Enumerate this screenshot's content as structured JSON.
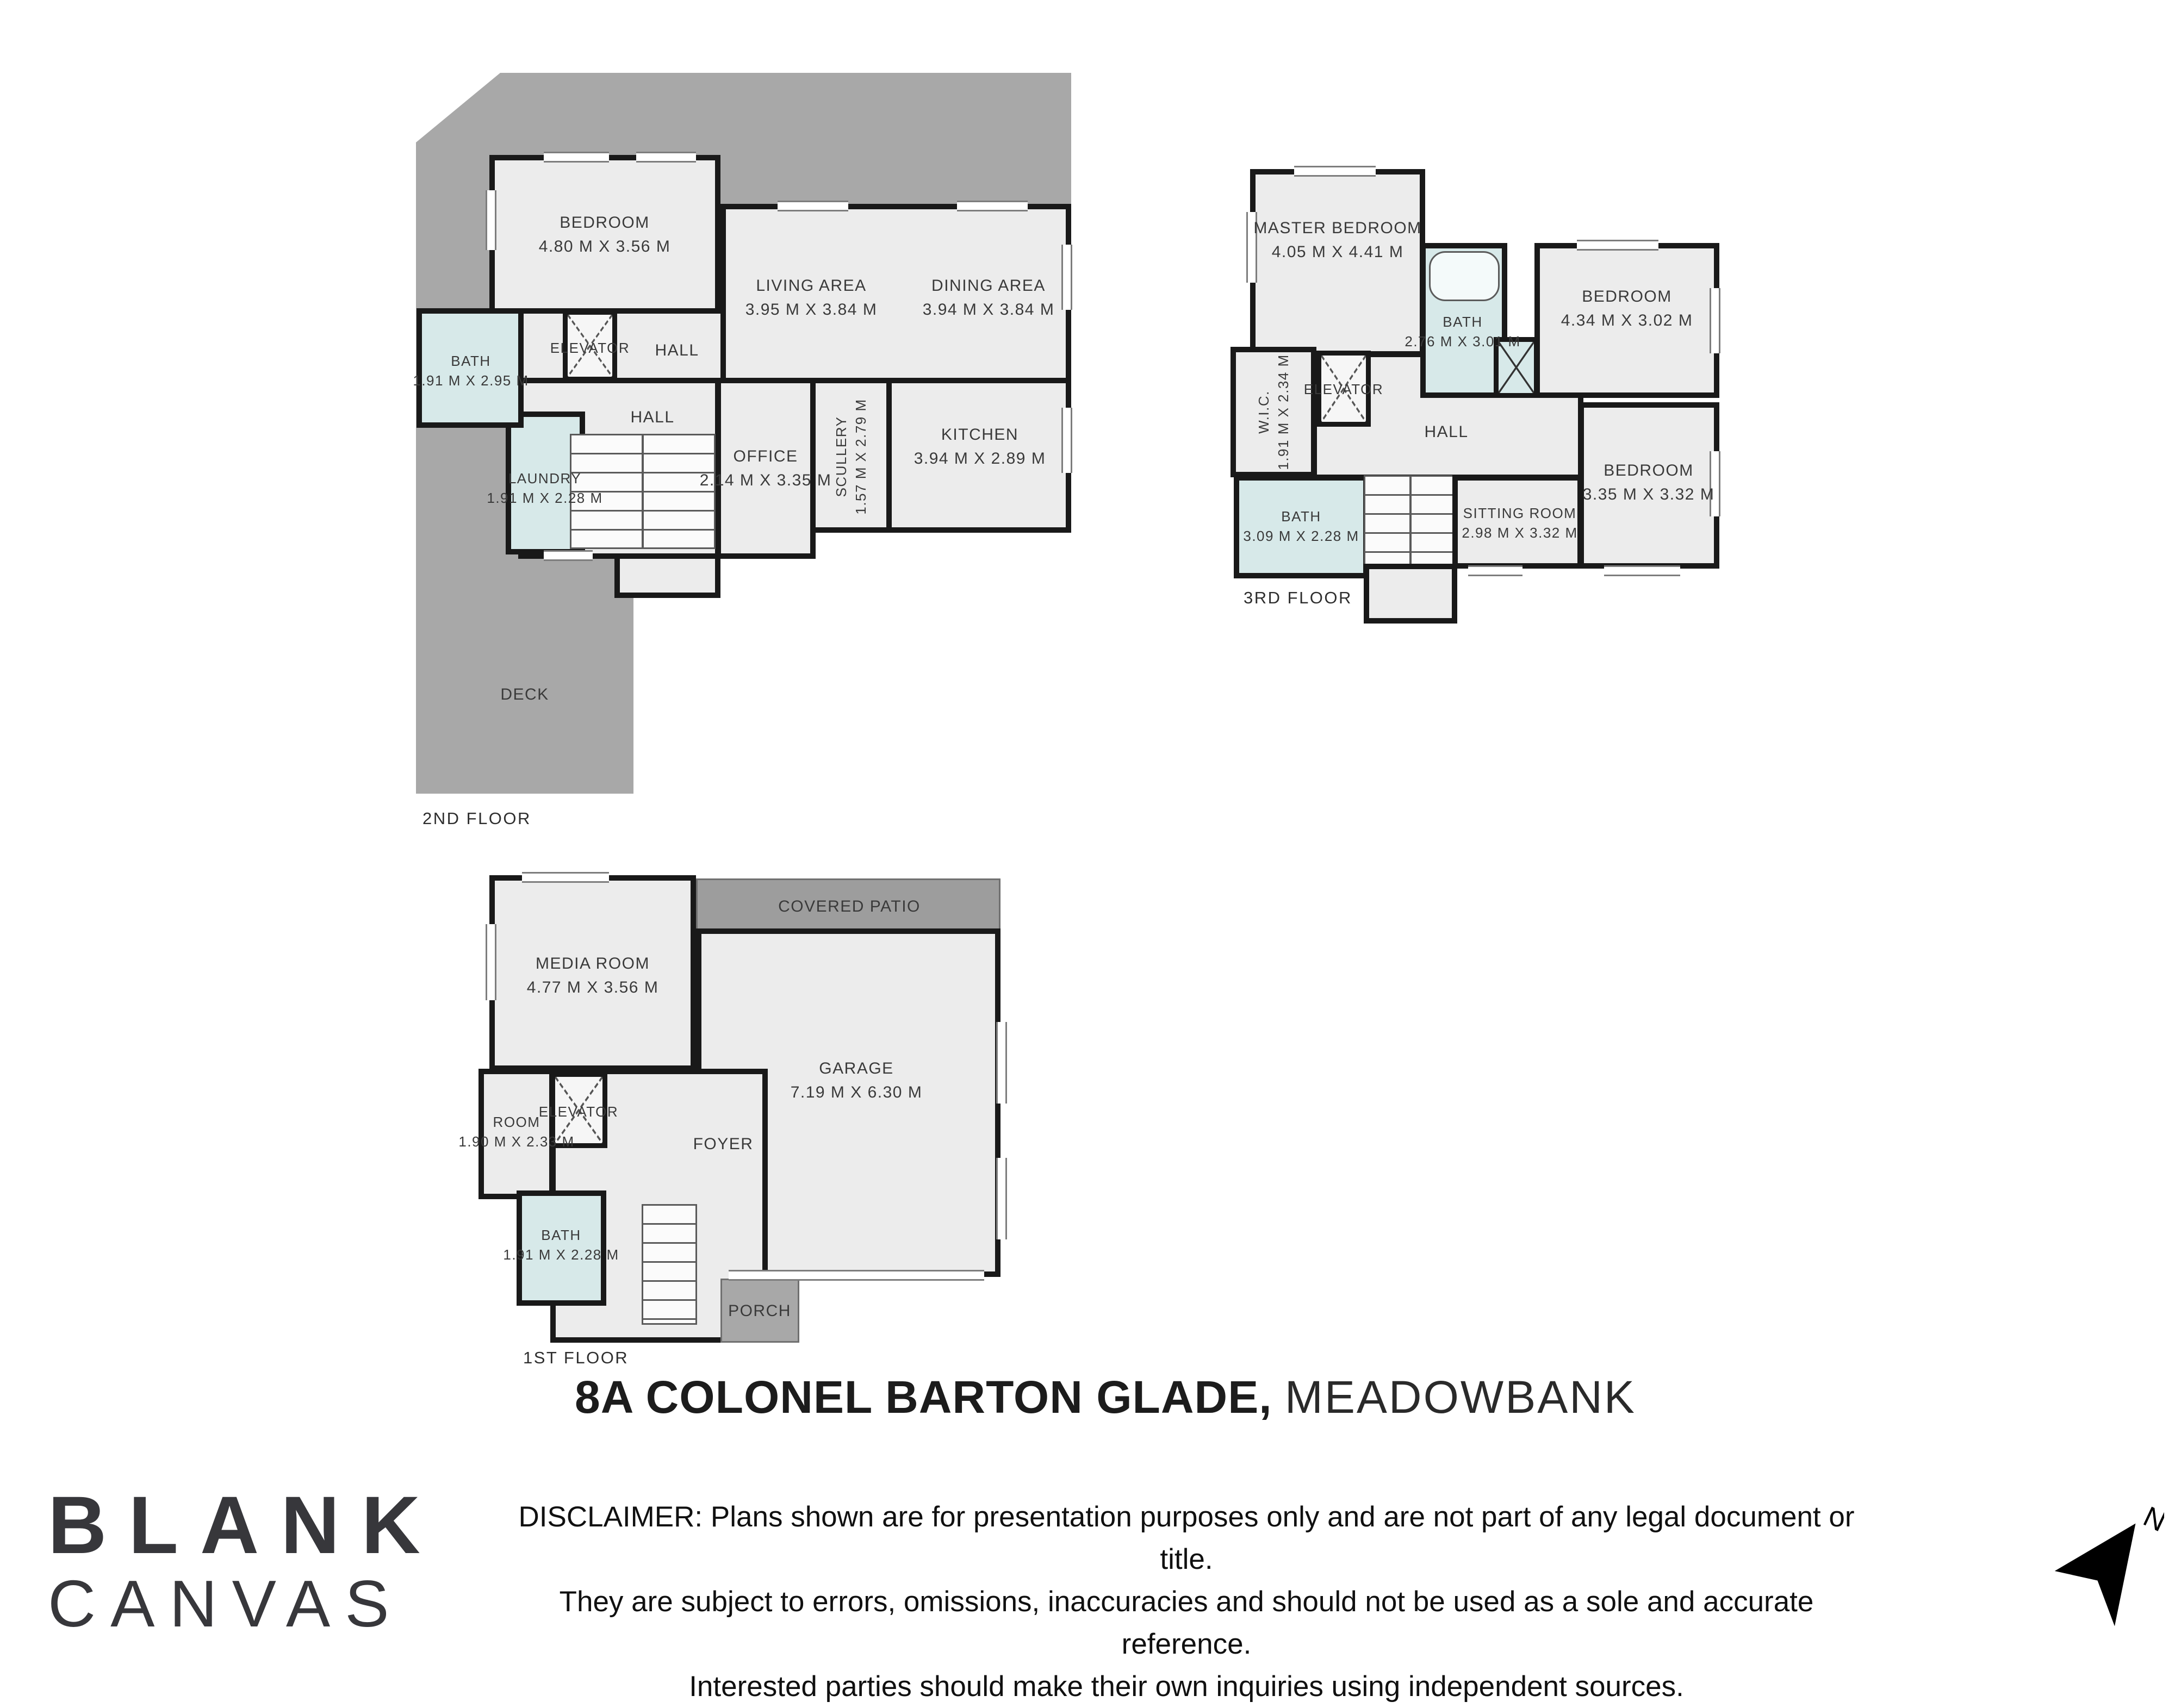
{
  "title": {
    "address": "8A COLONEL BARTON GLADE,",
    "suburb": "MEADOWBANK"
  },
  "floors": [
    {
      "label": "2ND FLOOR",
      "rooms": [
        {
          "name": "BEDROOM",
          "dims": "4.80 M X 3.56 M"
        },
        {
          "name": "LIVING AREA",
          "dims": "3.95 M X 3.84 M"
        },
        {
          "name": "DINING AREA",
          "dims": "3.94 M X 3.84 M"
        },
        {
          "name": "HALL"
        },
        {
          "name": "ELEVATOR"
        },
        {
          "name": "BATH",
          "dims": "1.91 M X 2.95 M"
        },
        {
          "name": "HALL"
        },
        {
          "name": "LAUNDRY",
          "dims": "1.91 M X 2.28 M"
        },
        {
          "name": "OFFICE",
          "dims": "2.14 M X 3.35 M"
        },
        {
          "name": "SCULLERY",
          "dims": "1.57 M X 2.79 M"
        },
        {
          "name": "KITCHEN",
          "dims": "3.94 M X 2.89 M"
        },
        {
          "name": "DECK"
        }
      ]
    },
    {
      "label": "3RD FLOOR",
      "rooms": [
        {
          "name": "MASTER BEDROOM",
          "dims": "4.05 M X 4.41 M"
        },
        {
          "name": "BATH",
          "dims": "2.76 M X 3.01 M"
        },
        {
          "name": "BEDROOM",
          "dims": "4.34 M X 3.02 M"
        },
        {
          "name": "W.I.C.",
          "dims": "1.91 M X 2.34 M"
        },
        {
          "name": "ELEVATOR"
        },
        {
          "name": "HALL"
        },
        {
          "name": "BATH",
          "dims": "3.09 M X 2.28 M"
        },
        {
          "name": "SITTING ROOM",
          "dims": "2.98 M X 3.32 M"
        },
        {
          "name": "BEDROOM",
          "dims": "3.35 M X 3.32 M"
        }
      ]
    },
    {
      "label": "1ST FLOOR",
      "rooms": [
        {
          "name": "MEDIA ROOM",
          "dims": "4.77 M X 3.56 M"
        },
        {
          "name": "COVERED PATIO"
        },
        {
          "name": "GARAGE",
          "dims": "7.19 M X 6.30 M"
        },
        {
          "name": "ROOM",
          "dims": "1.90 M X 2.33 M"
        },
        {
          "name": "ELEVATOR"
        },
        {
          "name": "FOYER"
        },
        {
          "name": "BATH",
          "dims": "1.91 M X 2.28 M"
        },
        {
          "name": "PORCH"
        }
      ]
    }
  ],
  "disclaimer": {
    "line1": "DISCLAIMER: Plans shown are for presentation purposes only and are not part of any legal document or title.",
    "line2": "They are subject to errors, omissions, inaccuracies and should not be used as a sole and accurate reference.",
    "line3": "Interested parties should make their own inquiries using independent sources."
  },
  "logo": {
    "line1": "BLANK",
    "line2": "CANVAS"
  },
  "north_label": "N",
  "colors": {
    "wall": "#191919",
    "floor_fill": "#ececec",
    "wet_room_fill": "#d7e9e9",
    "deck_gray": "#a8a8a8",
    "label_text": "#3a3a3a"
  }
}
